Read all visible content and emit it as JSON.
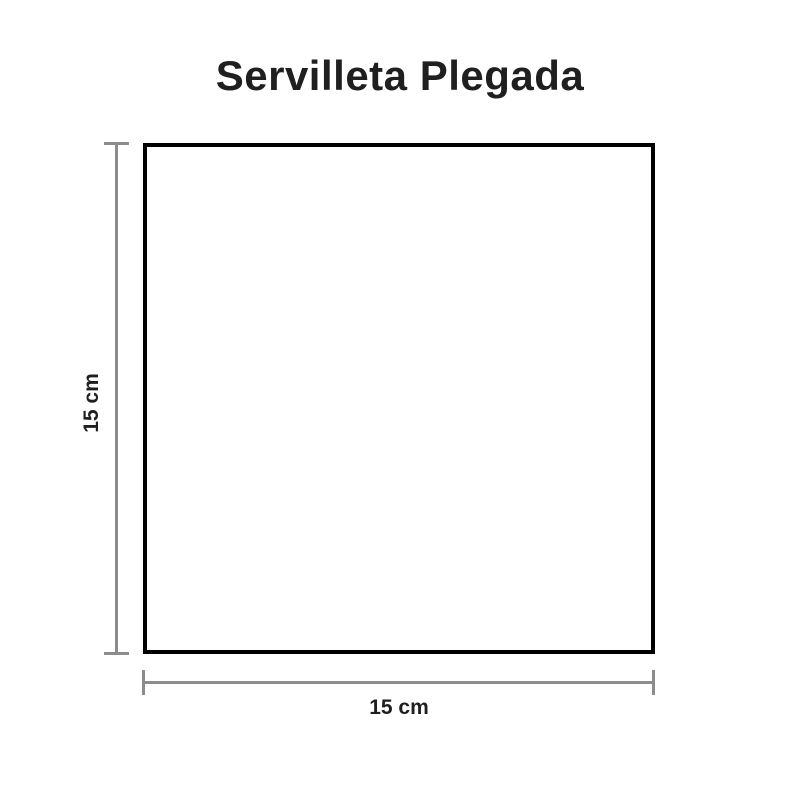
{
  "title": "Servilleta Plegada",
  "figure": {
    "shape": "square",
    "fill_color": "#ffffff",
    "border_color": "#000000"
  },
  "dimensions": {
    "height": {
      "label": "15 cm"
    },
    "width": {
      "label": "15 cm"
    }
  },
  "style": {
    "background_color": "#ffffff",
    "dimension_line_color": "#8c8c8c",
    "text_color": "#1f1f1f",
    "shape_border_color": "#000000",
    "shape_fill_color": "#ffffff"
  }
}
